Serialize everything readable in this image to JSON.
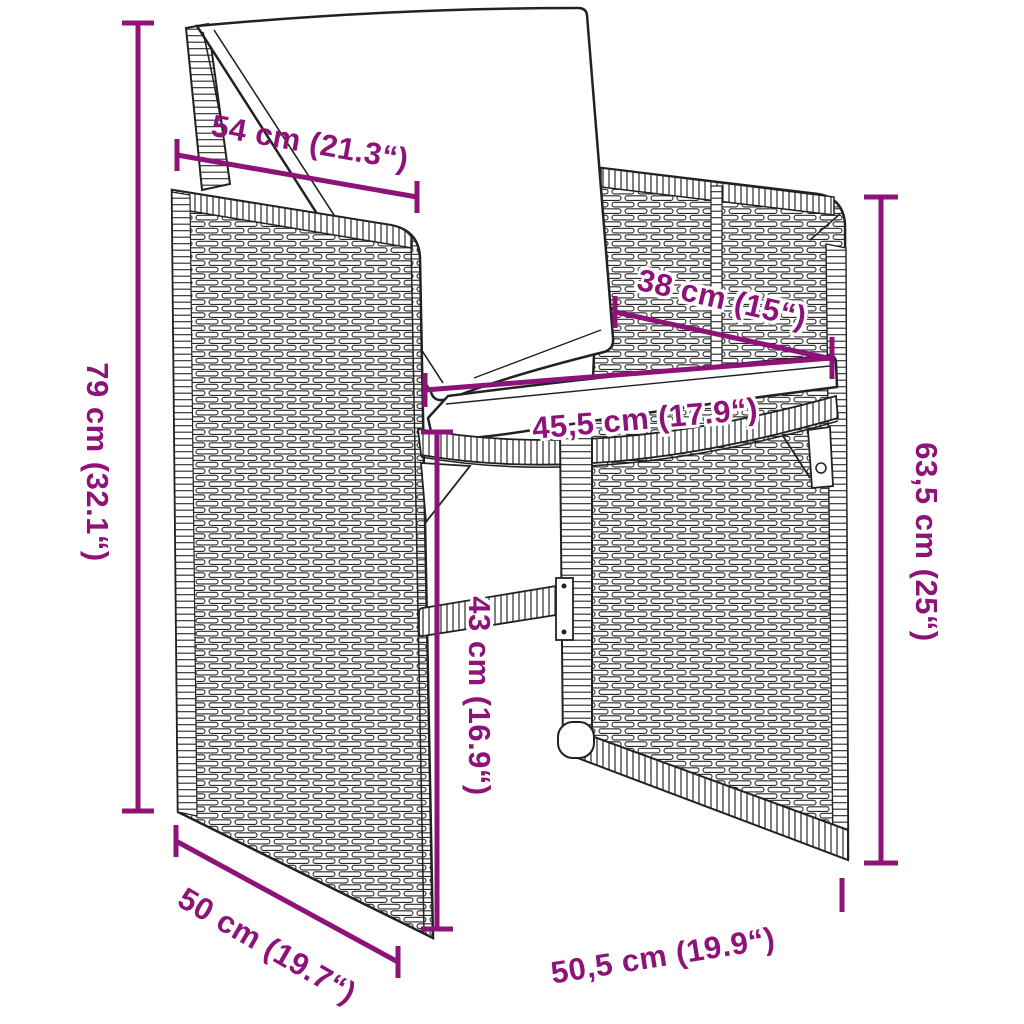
{
  "diagram": {
    "type": "product-dimension-diagram",
    "product": "poly rattan garden chair with cushions",
    "accent_color": "#8E1379",
    "outline_color": "#222222",
    "background_color": "#FFFFFF",
    "dimensions": [
      {
        "id": "top-width",
        "label": "54 cm (21.3“)"
      },
      {
        "id": "back-height",
        "label": "79 cm (32.1“)"
      },
      {
        "id": "back-width",
        "label": "38 cm (15“)"
      },
      {
        "id": "seat-width",
        "label": "45,5 cm (17.9“)"
      },
      {
        "id": "seat-height",
        "label": "43 cm (16.9“)"
      },
      {
        "id": "overall-height-right",
        "label": "63,5 cm (25“)"
      },
      {
        "id": "depth",
        "label": "50 cm (19.7“)"
      },
      {
        "id": "bottom-width",
        "label": "50,5 cm (19.9“)"
      }
    ]
  }
}
